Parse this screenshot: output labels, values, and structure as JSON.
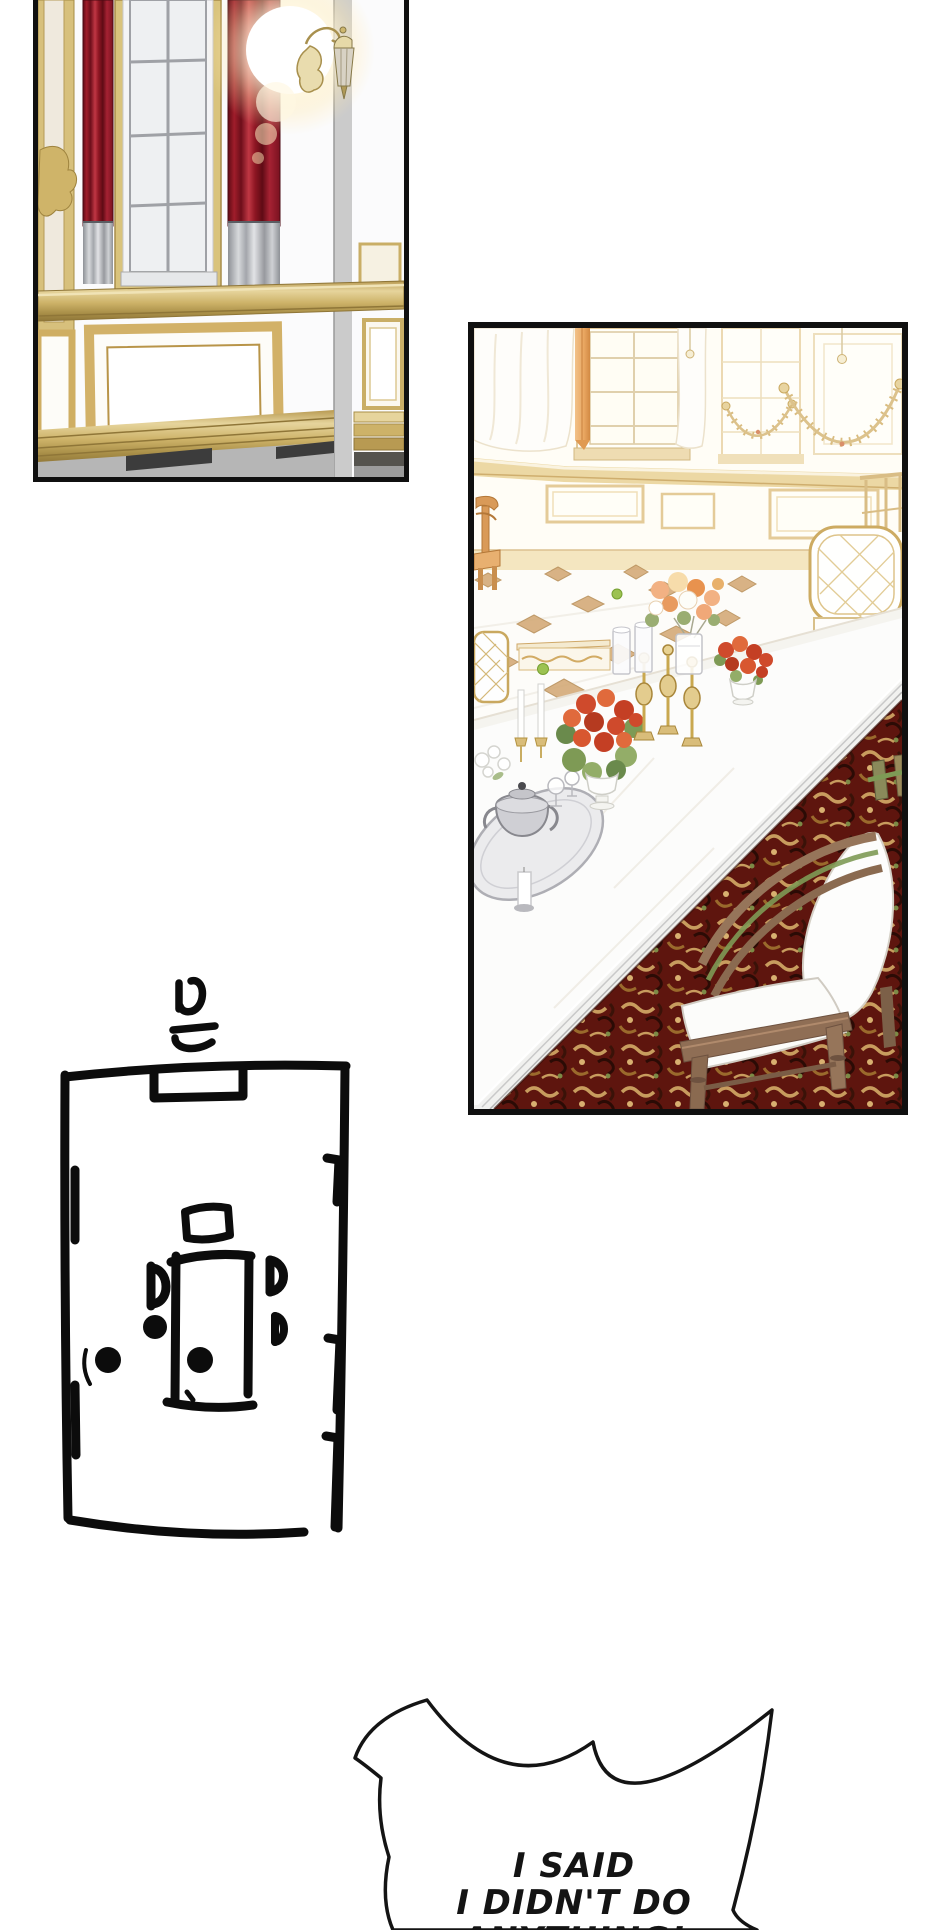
{
  "page": {
    "width": 940,
    "height": 1930,
    "background": "#ffffff"
  },
  "panels": [
    {
      "id": "palace-wall",
      "description": "Palace interior wall with tall window, red curtains, gold mouldings and a glowing wall sconce"
    },
    {
      "id": "dining-room",
      "description": "Bright palace dining room with long white table, flowers, candlesticks, chairs and an ornate red carpet"
    }
  ],
  "sketch": {
    "description": "Hand-drawn floor plan of the dining room with table, chairs, door and window marks",
    "doodle_character": "믄"
  },
  "speech_bubble": {
    "lines": [
      "I SAID",
      "I DIDN'T DO",
      "ANYTHING!"
    ]
  },
  "palette": {
    "panel_border": "#101010",
    "gold_trim": "#d5bb78",
    "curtain_red": "#8e1623",
    "curtain_silver": "#b9bcc0",
    "wall_white": "#fbfbfc",
    "dining_cream": "#fffdf6",
    "curtain_orange": "#e9a661",
    "carpet_maroon": "#5e150e",
    "carpet_tan": "#c89c5e",
    "wood_brown": "#8a6a50",
    "flower_red": "#cf4a2c",
    "flower_peach": "#f0a878",
    "ink_black": "#141414"
  }
}
